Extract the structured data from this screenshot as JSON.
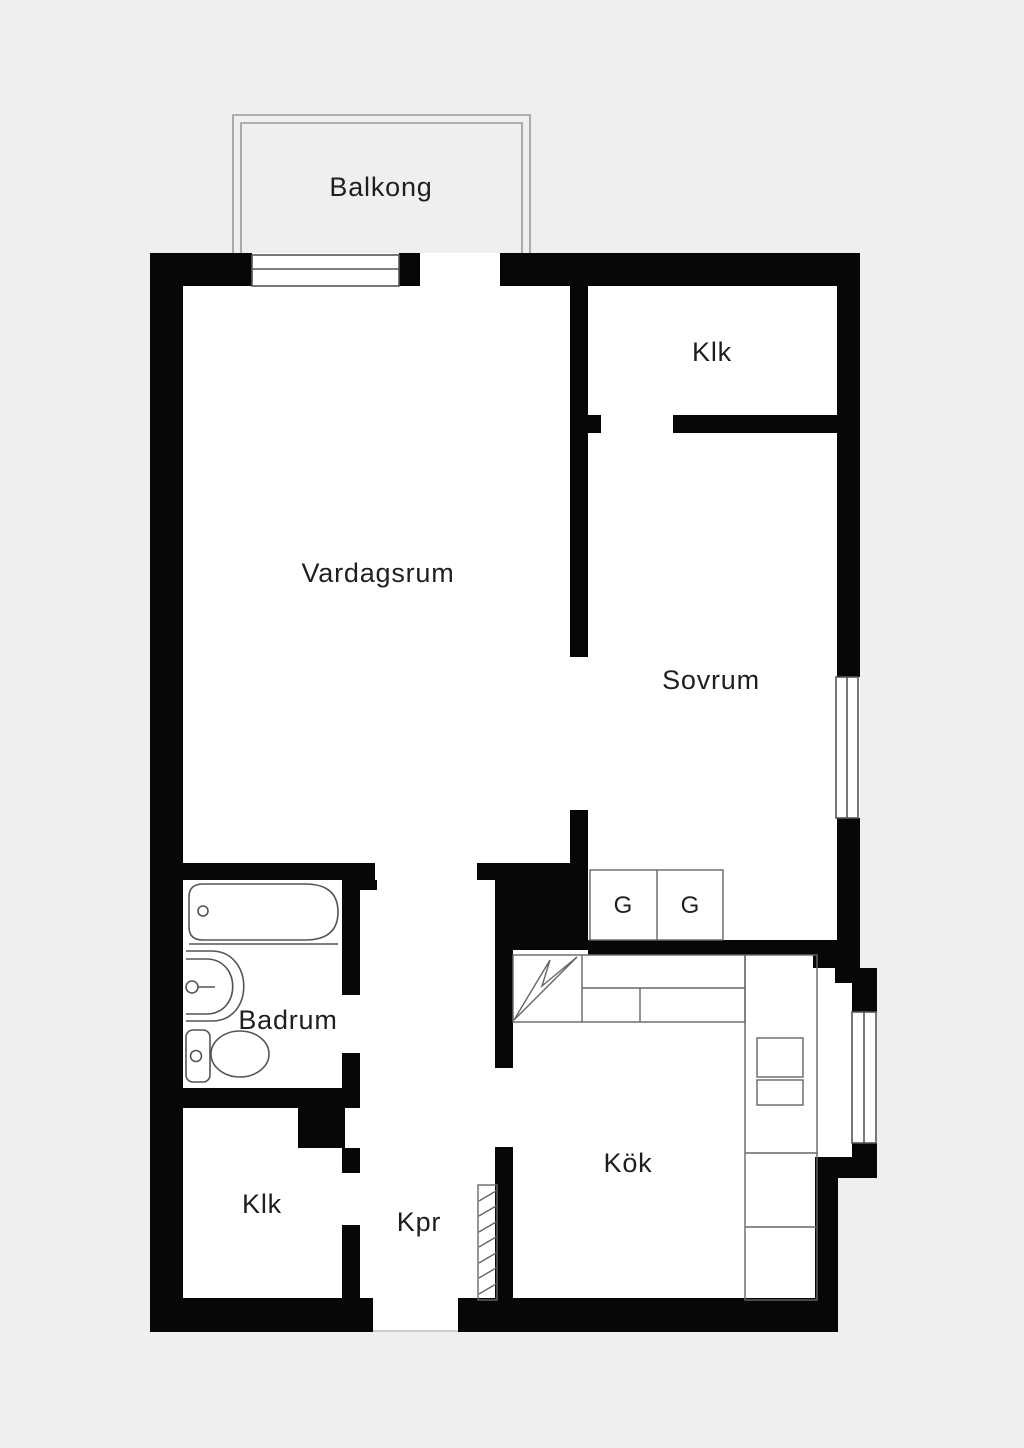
{
  "plan": {
    "colors": {
      "background": "#efefef",
      "floor": "#ffffff",
      "wall": "#070707",
      "fixture_line": "#555555",
      "balcony_line": "#9a9a9a",
      "text": "#1f1f1f"
    },
    "rooms": {
      "balkong": {
        "label": "Balkong"
      },
      "vardagsrum": {
        "label": "Vardagsrum"
      },
      "klk_top": {
        "label": "Klk"
      },
      "sovrum": {
        "label": "Sovrum"
      },
      "badrum": {
        "label": "Badrum"
      },
      "klk_bottom": {
        "label": "Klk"
      },
      "kpr": {
        "label": "Kpr"
      },
      "kok": {
        "label": "Kök"
      },
      "wardrobe_left": {
        "label": "G"
      },
      "wardrobe_right": {
        "label": "G"
      }
    }
  }
}
